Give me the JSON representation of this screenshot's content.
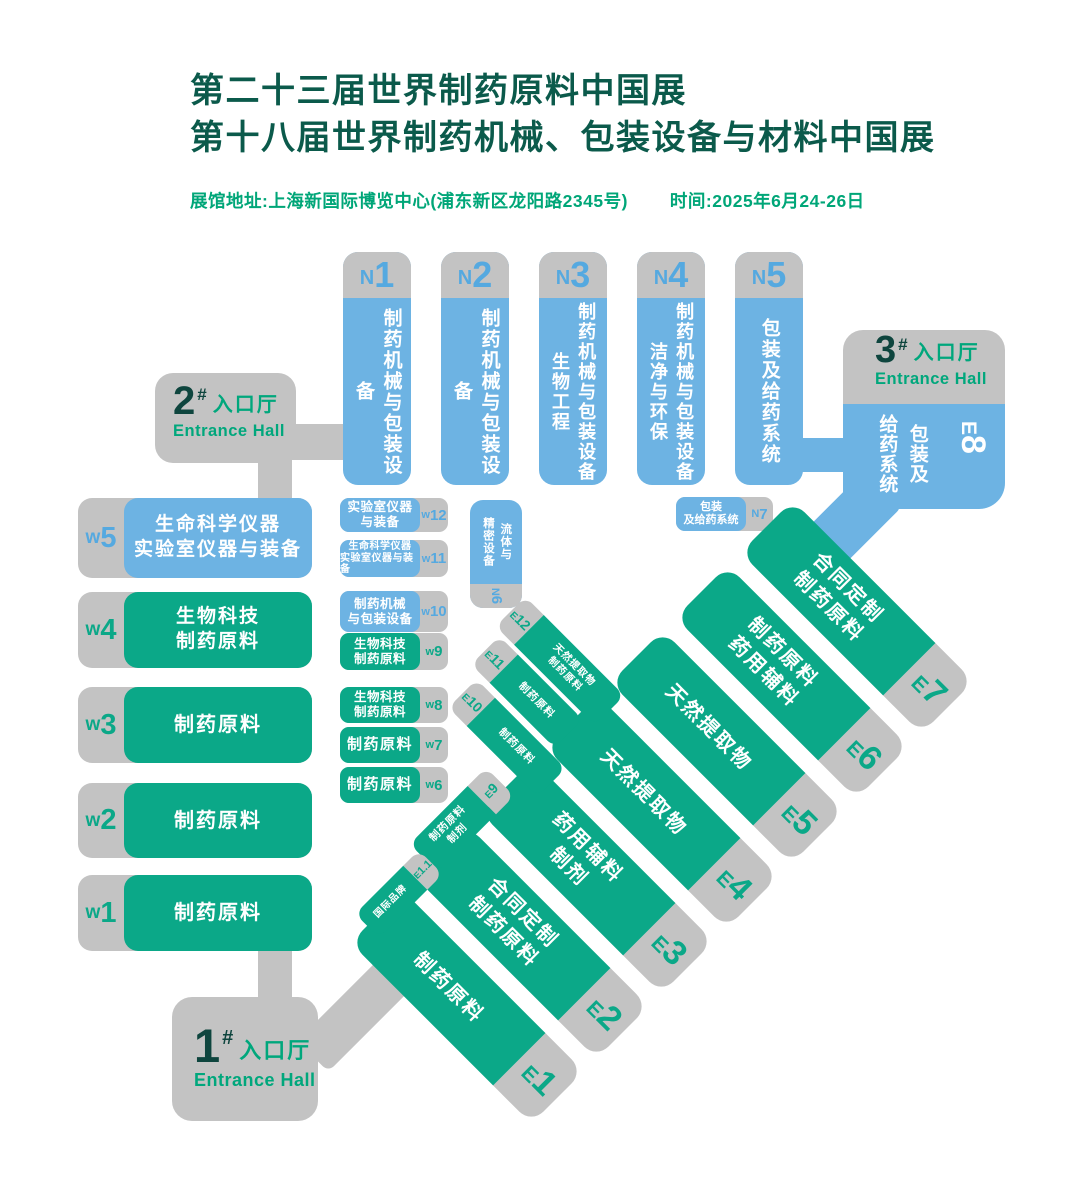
{
  "header": {
    "title_line1": "第二十三届世界制药原料中国展",
    "title_line2": "第十八届世界制药机械、包装设备与材料中国展",
    "venue": "展馆地址:上海新国际博览中心(浦东新区龙阳路2345号)",
    "time": "时间:2025年6月24-26日"
  },
  "entrances": {
    "hall1": {
      "num": "1",
      "hash": "#",
      "cn": "入口厅",
      "en": "Entrance Hall"
    },
    "hall2": {
      "num": "2",
      "hash": "#",
      "cn": "入口厅",
      "en": "Entrance Hall"
    },
    "hall3": {
      "num": "3",
      "hash": "#",
      "cn": "入口厅",
      "en": "Entrance Hall"
    }
  },
  "north_halls": [
    {
      "letter": "N",
      "num": "1",
      "lines": [
        "制药机械与包装设备"
      ]
    },
    {
      "letter": "N",
      "num": "2",
      "lines": [
        "制药机械与包装设备"
      ]
    },
    {
      "letter": "N",
      "num": "3",
      "lines": [
        "制药机械与包装设备",
        "生物工程"
      ]
    },
    {
      "letter": "N",
      "num": "4",
      "lines": [
        "制药机械与包装设备",
        "洁净与环保"
      ]
    },
    {
      "letter": "N",
      "num": "5",
      "lines": [
        "包装及给药系统"
      ]
    }
  ],
  "north_small": {
    "n6": {
      "letter": "N",
      "num": "6",
      "lines": [
        "流体与",
        "精密设备"
      ]
    },
    "n7": {
      "letter": "N",
      "num": "7",
      "lines": [
        "包装",
        "及给药系统"
      ]
    }
  },
  "west_left": [
    {
      "letter": "w",
      "num": "5",
      "lines": [
        "生命科学仪器",
        "实验室仪器与装备"
      ]
    },
    {
      "letter": "w",
      "num": "4",
      "lines": [
        "生物科技",
        "制药原料"
      ]
    },
    {
      "letter": "w",
      "num": "3",
      "lines": [
        "制药原料"
      ]
    },
    {
      "letter": "w",
      "num": "2",
      "lines": [
        "制药原料"
      ]
    },
    {
      "letter": "w",
      "num": "1",
      "lines": [
        "制药原料"
      ]
    }
  ],
  "west_mid": [
    {
      "letter": "w",
      "num": "12",
      "lines": [
        "实验室仪器",
        "与装备"
      ]
    },
    {
      "letter": "w",
      "num": "11",
      "lines": [
        "生命科学仪器",
        "实验室仪器与装备"
      ]
    },
    {
      "letter": "w",
      "num": "10",
      "lines": [
        "制药机械",
        "与包装设备"
      ]
    },
    {
      "letter": "w",
      "num": "9",
      "lines": [
        "生物科技",
        "制药原料"
      ]
    },
    {
      "letter": "w",
      "num": "8",
      "lines": [
        "生物科技",
        "制药原料"
      ]
    },
    {
      "letter": "w",
      "num": "7",
      "lines": [
        "制药原料"
      ]
    },
    {
      "letter": "w",
      "num": "6",
      "lines": [
        "制药原料"
      ]
    }
  ],
  "east_halls": [
    {
      "letter": "E",
      "num": "1",
      "lines": [
        "制药原料"
      ]
    },
    {
      "letter": "E",
      "num": "2",
      "lines": [
        "合同定制",
        "制药原料"
      ]
    },
    {
      "letter": "E",
      "num": "3",
      "lines": [
        "药用辅料",
        "制剂"
      ]
    },
    {
      "letter": "E",
      "num": "4",
      "lines": [
        "天然提取物"
      ]
    },
    {
      "letter": "E",
      "num": "5",
      "lines": [
        "天然提取物"
      ]
    },
    {
      "letter": "E",
      "num": "6",
      "lines": [
        "制药原料",
        "药用辅料"
      ]
    },
    {
      "letter": "E",
      "num": "7",
      "lines": [
        "合同定制",
        "制药原料"
      ]
    }
  ],
  "east_small": [
    {
      "letter": "E",
      "num": "12",
      "lines": [
        "天然提取物",
        "制药原料"
      ]
    },
    {
      "letter": "E",
      "num": "11",
      "lines": [
        "制药原料"
      ]
    },
    {
      "letter": "E",
      "num": "10",
      "lines": [
        "制药原料"
      ]
    },
    {
      "letter": "E",
      "num": "9",
      "lines": [
        "制药原料",
        "制剂"
      ]
    },
    {
      "letter": "E",
      "num": "1.1",
      "lines": [
        "国际品牌"
      ]
    }
  ],
  "e8": {
    "letter": "E",
    "num": "8",
    "lines": [
      "包装及",
      "给药系统"
    ]
  },
  "colors": {
    "hall_green": "#0ba888",
    "hall_blue": "#6db3e3",
    "connector_gray": "#c3c3c3",
    "label_blue": "#55a9e0",
    "title_dark_green": "#0b5a4b",
    "accent_green": "#00a678",
    "entrance_number": "#0e453e"
  }
}
